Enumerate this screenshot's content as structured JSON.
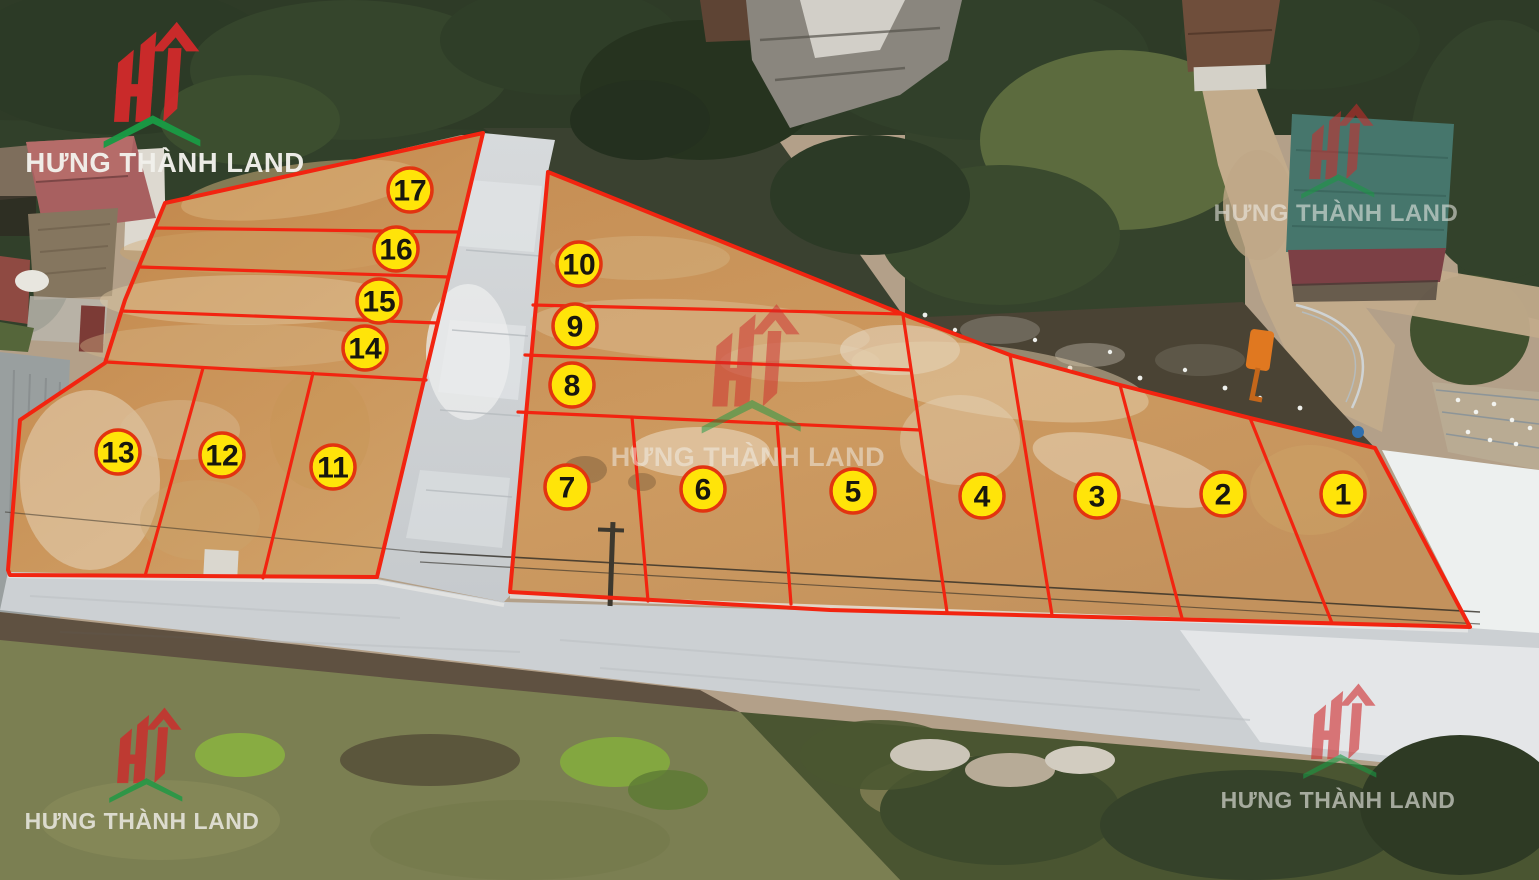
{
  "brand": {
    "name": "HƯNG THÀNH LAND"
  },
  "theme": {
    "boundary": "#f22410",
    "badge_fill": "#ffe409",
    "badge_border": "#e23410",
    "badge_number": "#17170e",
    "logo_red": "#cf2a2b",
    "logo_green": "#1a9a44",
    "brand_text": "#f2f1ec"
  },
  "map": {
    "description": "Aerial drone photo of a residential land subdivision: 17 numbered plots outlined in red, concrete roads, houses and trees around, watermarked by the brand.",
    "plot_count": 17,
    "plots": [
      {
        "label": "1",
        "x": 1343,
        "y": 494
      },
      {
        "label": "2",
        "x": 1223,
        "y": 494
      },
      {
        "label": "3",
        "x": 1097,
        "y": 496
      },
      {
        "label": "4",
        "x": 982,
        "y": 496
      },
      {
        "label": "5",
        "x": 853,
        "y": 491
      },
      {
        "label": "6",
        "x": 703,
        "y": 489
      },
      {
        "label": "7",
        "x": 567,
        "y": 487
      },
      {
        "label": "8",
        "x": 572,
        "y": 385
      },
      {
        "label": "9",
        "x": 575,
        "y": 326
      },
      {
        "label": "10",
        "x": 579,
        "y": 264
      },
      {
        "label": "11",
        "x": 333,
        "y": 467
      },
      {
        "label": "12",
        "x": 222,
        "y": 455
      },
      {
        "label": "13",
        "x": 118,
        "y": 452
      },
      {
        "label": "14",
        "x": 365,
        "y": 348
      },
      {
        "label": "15",
        "x": 379,
        "y": 301
      },
      {
        "label": "16",
        "x": 396,
        "y": 249
      },
      {
        "label": "17",
        "x": 410,
        "y": 190
      }
    ],
    "watermarks": [
      {
        "position": "top-left"
      },
      {
        "position": "top-right"
      },
      {
        "position": "center"
      },
      {
        "position": "bottom-left"
      },
      {
        "position": "bottom-right"
      }
    ]
  }
}
